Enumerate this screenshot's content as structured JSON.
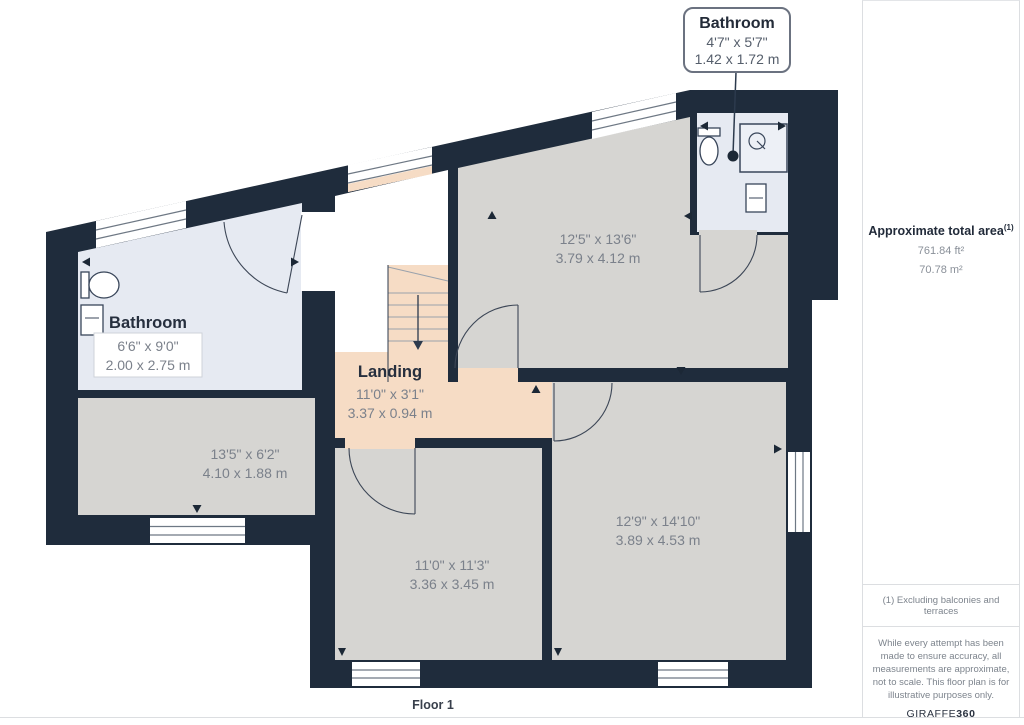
{
  "floor_label": "Floor 1",
  "callout": {
    "title": "Bathroom",
    "imperial": "4'7\" x 5'7\"",
    "metric": "1.42 x 1.72 m"
  },
  "rooms": {
    "bathroom_left": {
      "name": "Bathroom",
      "imperial": "6'6\" x 9'0\"",
      "metric": "2.00 x 2.75 m"
    },
    "room_top_right": {
      "imperial": "12'5\" x 13'6\"",
      "metric": "3.79 x 4.12 m"
    },
    "room_left": {
      "imperial": "13'5\" x 6'2\"",
      "metric": "4.10 x 1.88 m"
    },
    "landing": {
      "name": "Landing",
      "imperial": "11'0\" x 3'1\"",
      "metric": "3.37 x 0.94 m"
    },
    "room_bottom_middle": {
      "imperial": "11'0\" x 11'3\"",
      "metric": "3.36 x 3.45 m"
    },
    "room_bottom_right": {
      "imperial": "12'9\" x 14'10\"",
      "metric": "3.89 x 4.53 m"
    }
  },
  "sidebar": {
    "total_area_label": "Approximate total area",
    "total_area_superscript": "(1)",
    "area_ft": "761.84 ft²",
    "area_m": "70.78 m²",
    "footnote": "(1) Excluding balconies and terraces",
    "disclaimer": "While every attempt has been made to ensure accuracy, all measurements are approximate, not to scale. This floor plan is for illustrative purposes only.",
    "brand_regular": "GIRAFFE",
    "brand_bold": "360"
  },
  "colors": {
    "wall": "#1f2c3c",
    "room_fill": "#d6d5d2",
    "bathroom_fill": "#e6eaf2",
    "landing_fill": "#f6dcc5",
    "window_line": "#6e7884",
    "callout_border": "#6b7280",
    "text_dark": "#262f3e",
    "text_dim": "#7b818b"
  }
}
